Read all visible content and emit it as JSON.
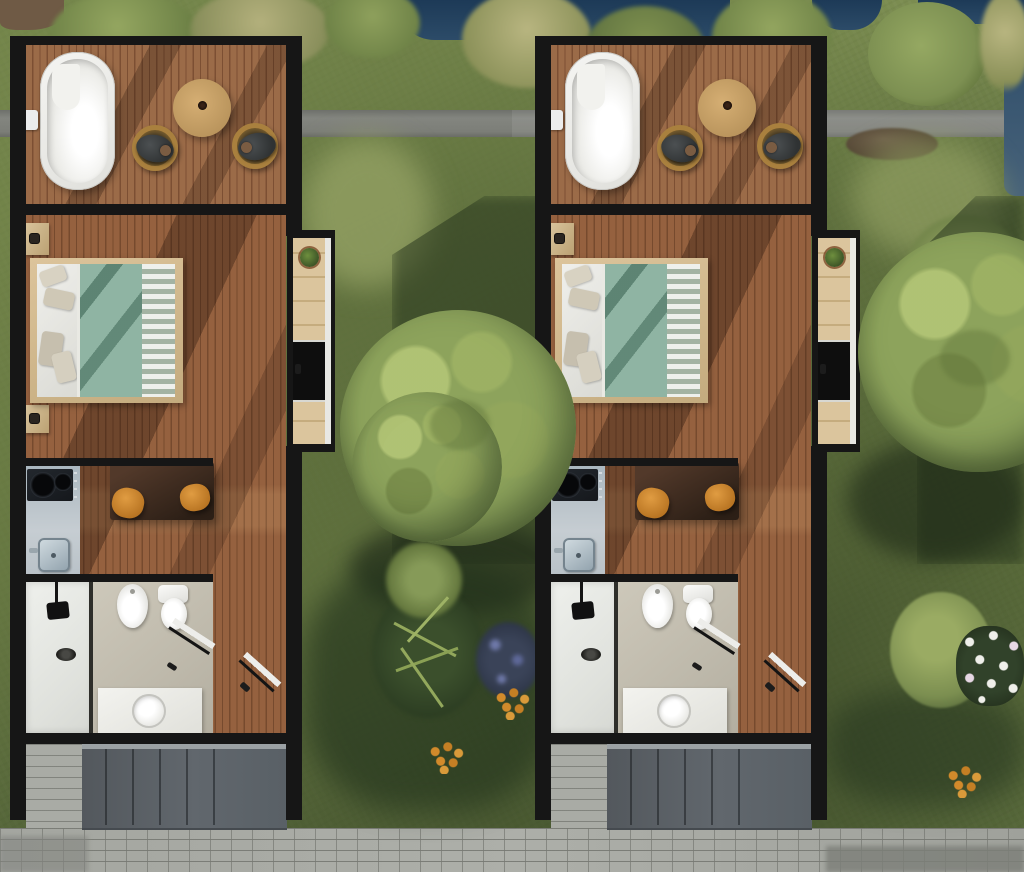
{
  "scene": {
    "type": "architectural-site-plan",
    "view": "top-down-render",
    "width_px": 1024,
    "height_px": 872,
    "units_count": 2
  },
  "units": [
    {
      "id": "cabin-unit-1",
      "x": 10
    },
    {
      "id": "cabin-unit-2",
      "x": 535
    }
  ],
  "unit_contents": {
    "deck": [
      "bathtub",
      "bathtub-faucet",
      "outdoor-dining-table",
      "coffee-cup",
      "patio-chair",
      "patio-chair",
      "seated-person",
      "seated-person"
    ],
    "bedroom": [
      "double-bed",
      "pillows",
      "duvet",
      "striped-runner",
      "nightstand",
      "nightstand"
    ],
    "entry-porch": [
      "potted-plant",
      "entry-door",
      "bench-panel"
    ],
    "kitchen": [
      "kitchen-counter",
      "cooktop-two-burners",
      "kitchen-sink",
      "dining-table",
      "stool",
      "stool"
    ],
    "bathroom": [
      "shower",
      "shower-head",
      "floor-drain",
      "bidet",
      "toilet",
      "vanity",
      "wash-basin",
      "bathroom-door"
    ],
    "rear": [
      "exterior-door",
      "rear-porch-slab",
      "paver-strip"
    ]
  },
  "environment": {
    "features": [
      "lawn",
      "asphalt-path",
      "pond-edge",
      "paver-walkway",
      "rocks",
      "tall-grass-clumps",
      "deciduous-tree",
      "deciduous-tree",
      "shrub",
      "palm-bush",
      "white-daisy-patch",
      "orange-flower-clusters",
      "purple-flower-patch",
      "cast-shadows"
    ]
  },
  "palette": {
    "grass": "#76884c",
    "grass_light": "#9aa768",
    "grass_shadow": "#22301a",
    "water": "#1d3a57",
    "road": "#7c7e78",
    "paver": "#a7a9a3",
    "paver_dark": "#7c7e78",
    "wall": "#161616",
    "deck_wood": "#9b6b48",
    "deck_wood_line": "#7c4f33",
    "floor_wood": "#95613f",
    "floor_wood_line": "#764a2e",
    "bathtub": "#f1f1ee",
    "outdoor_table": "#c9a266",
    "stool": "#cf8a2f",
    "duvet": "#8fb4a3",
    "bed_frame": "#d6bd94",
    "linen": "#ebebe6",
    "counter": "#b7c3c9",
    "sink_steel": "#9fb0ba",
    "cooktop": "#1d2126",
    "bath_floor": "#c7c2b4",
    "shower_floor": "#e9eae6",
    "fixture_white": "#f4f4f2",
    "porch_slab": "#5c6166",
    "tree_canopy": "#8da35c",
    "tree_highlight": "#aabb6e",
    "flower_orange": "#d28a2b",
    "flower_white": "#efefea",
    "flower_purple": "#6e78a8",
    "plant_green": "#4e6b33",
    "person_clothing": "#35383a",
    "chair_wicker": "#a9803e"
  }
}
